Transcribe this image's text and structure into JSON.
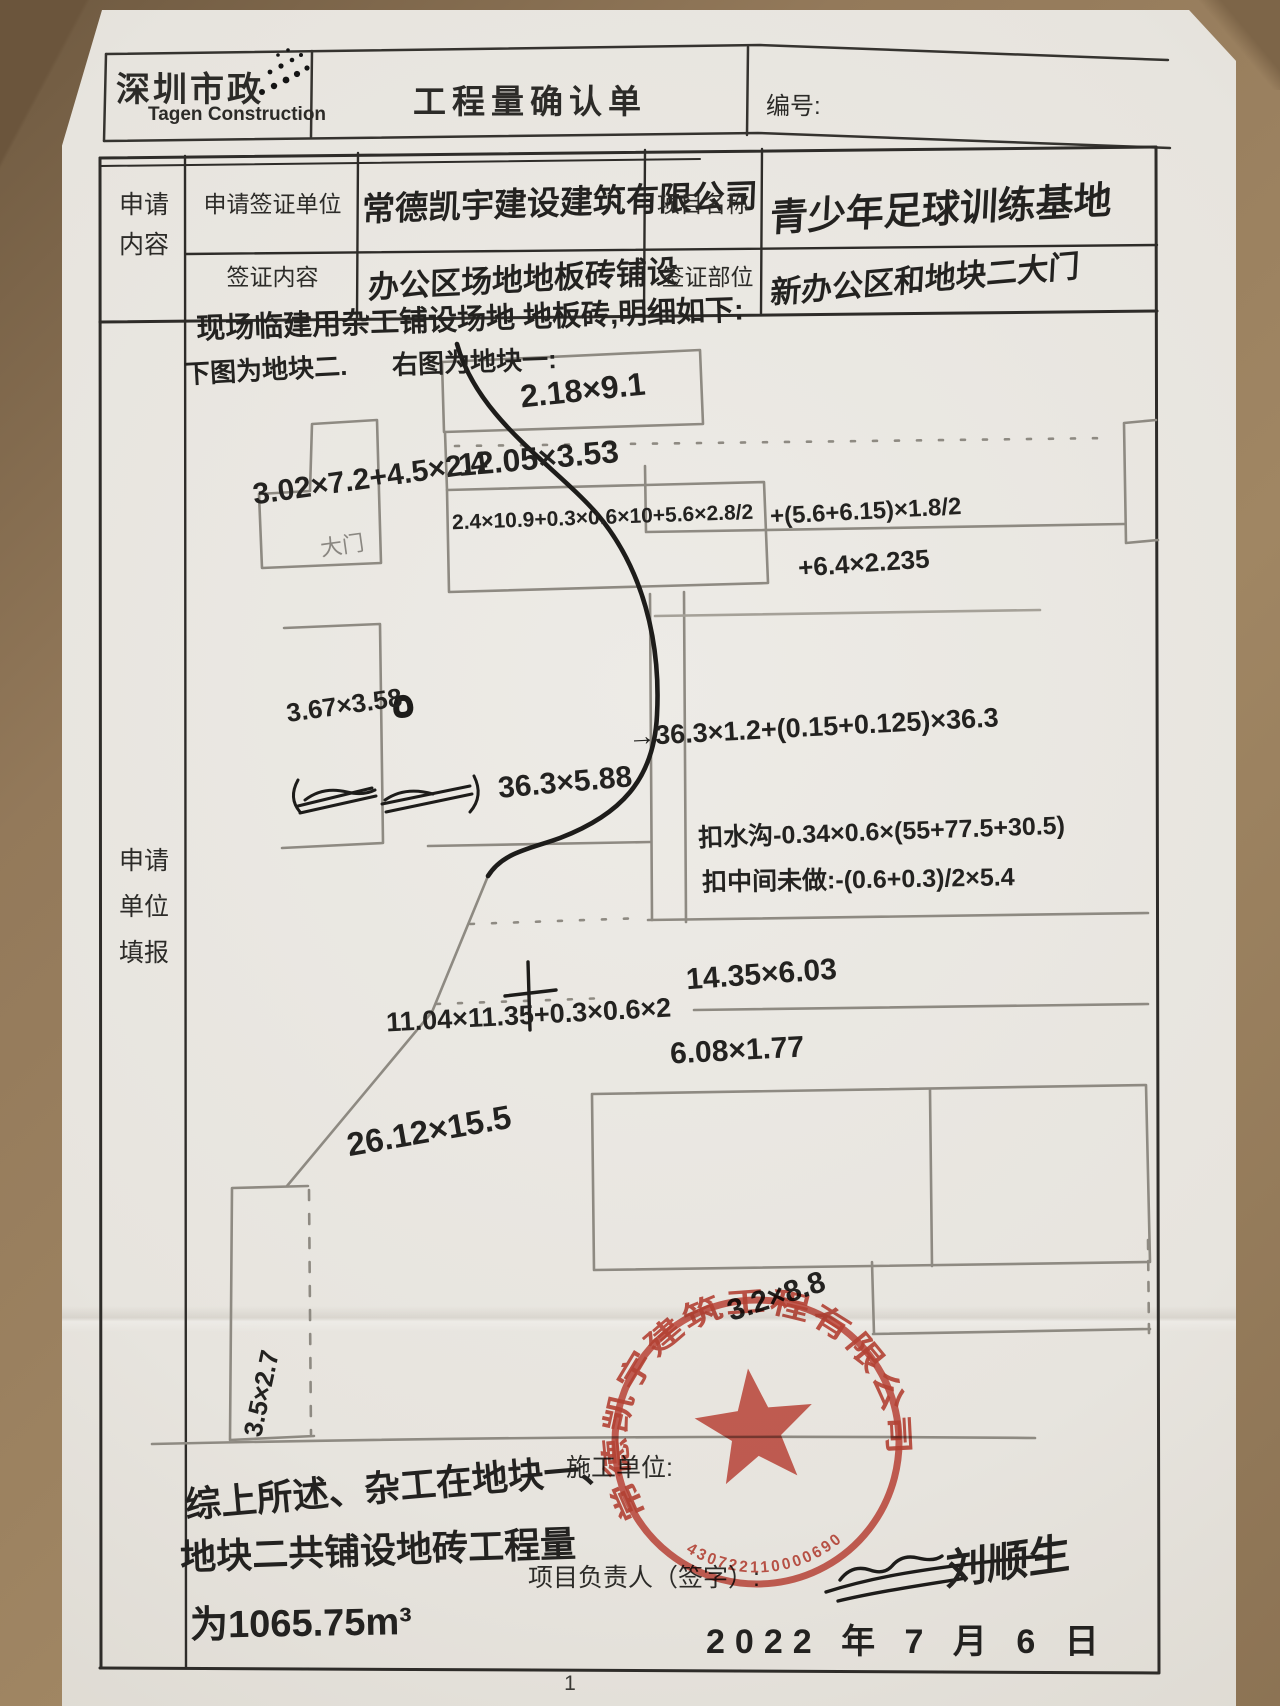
{
  "page": {
    "number": "1"
  },
  "header": {
    "logo_cn": "深圳市政",
    "logo_en": "Tagen Construction",
    "title": "工程量确认单",
    "serial_label": "编号:"
  },
  "form": {
    "section_label_top": "申请\n内容",
    "section_label_main": "申请\n单位\n填报",
    "row1": {
      "label": "申请签证单位",
      "value": "常德凯宇建设建筑有限公司",
      "label2": "项目名称",
      "value2": "青少年足球训练基地"
    },
    "row2": {
      "label": "签证内容",
      "value": "办公区场地地板砖铺设",
      "label2": "签证部位",
      "value2": "新办公区和地块二大门"
    }
  },
  "sketch": {
    "intro": "现场临建用杂工铺设场地 地板砖,明细如下:",
    "left_caption": "下图为地块二.",
    "right_caption": "右图为地块一:",
    "gate": "大门",
    "annotations": [
      {
        "text": "2.18×9.1"
      },
      {
        "text": "12.05×3.53"
      },
      {
        "text": "3.02×7.2+4.5×2.4"
      },
      {
        "text": "2.4×10.9+0.3×0.6×10+5.6×2.8/2"
      },
      {
        "text": "+(5.6+6.15)×1.8/2"
      },
      {
        "text": "+6.4×2.235"
      },
      {
        "text": "3.67×3.58"
      },
      {
        "text": "→36.3×1.2+(0.15+0.125)×36.3"
      },
      {
        "text": "36.3×5.88"
      },
      {
        "text": "扣水沟-0.34×0.6×(55+77.5+30.5)"
      },
      {
        "text": "扣中间未做:-(0.6+0.3)/2×5.4"
      },
      {
        "text": "14.35×6.03"
      },
      {
        "text": "11.04×11.35+0.3×0.6×2"
      },
      {
        "text": "6.08×1.77"
      },
      {
        "text": "26.12×15.5"
      },
      {
        "text": "3.5×2.7"
      }
    ]
  },
  "footer": {
    "summary_line1": "综上所述、杂工在地块一、",
    "summary_line2": "地块二共铺设地砖工程量",
    "summary_line3": "为1065.75m³",
    "contractor_label": "施工单位:",
    "manager_label": "项目负责人（签字）:",
    "signature": "刘顺生",
    "date": "2022 年 7 月 6 日",
    "seal": {
      "company": "常德凯宇建筑工程有限公司",
      "number": "430722110000690",
      "note": "3.2×8.8"
    }
  }
}
